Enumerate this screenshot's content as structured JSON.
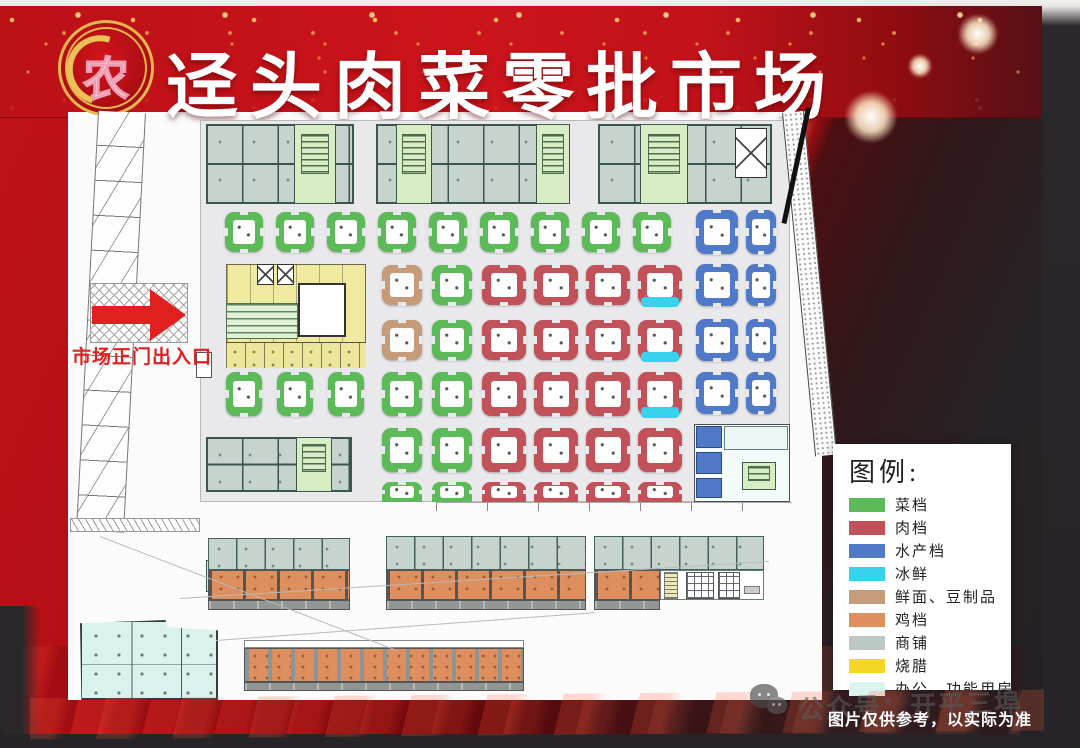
{
  "title": {
    "text": "迳头肉菜零批市场",
    "logo_char": "农"
  },
  "entrance": {
    "label": "市场正门出入口"
  },
  "legend": {
    "title": "图例:",
    "items": [
      {
        "key": "cai",
        "label": "菜档",
        "color": "#5cba58"
      },
      {
        "key": "rou",
        "label": "肉档",
        "color": "#c2525a"
      },
      {
        "key": "shuichan",
        "label": "水产档",
        "color": "#5079c8"
      },
      {
        "key": "bingxian",
        "label": "冰鲜",
        "color": "#38d2ee"
      },
      {
        "key": "xianmian",
        "label": "鲜面、豆制品",
        "color": "#c69b79"
      },
      {
        "key": "ji",
        "label": "鸡档",
        "color": "#e0905f"
      },
      {
        "key": "shangpu",
        "label": "商铺",
        "color": "#bcc8c4"
      },
      {
        "key": "shaola",
        "label": "烧腊",
        "color": "#f5d825"
      },
      {
        "key": "bangong",
        "label": "办公、功能用房",
        "color": "#dcf4f0"
      }
    ]
  },
  "footer": {
    "disclaimer": "图片仅供参考，以实际为准",
    "watermark": "公众号：开平三埠"
  },
  "plan": {
    "stalls": [
      {
        "t": "cai",
        "x": 225,
        "y": 212,
        "w": 38,
        "h": 40
      },
      {
        "t": "cai",
        "x": 276,
        "y": 212,
        "w": 38,
        "h": 40
      },
      {
        "t": "cai",
        "x": 327,
        "y": 212,
        "w": 38,
        "h": 40
      },
      {
        "t": "cai",
        "x": 378,
        "y": 212,
        "w": 38,
        "h": 40
      },
      {
        "t": "cai",
        "x": 429,
        "y": 212,
        "w": 38,
        "h": 40
      },
      {
        "t": "cai",
        "x": 480,
        "y": 212,
        "w": 38,
        "h": 40
      },
      {
        "t": "cai",
        "x": 531,
        "y": 212,
        "w": 38,
        "h": 40
      },
      {
        "t": "cai",
        "x": 582,
        "y": 212,
        "w": 38,
        "h": 40
      },
      {
        "t": "cai",
        "x": 633,
        "y": 212,
        "w": 38,
        "h": 40
      },
      {
        "t": "shuichan",
        "x": 696,
        "y": 210,
        "w": 42,
        "h": 44
      },
      {
        "t": "shuichan",
        "x": 746,
        "y": 210,
        "w": 30,
        "h": 44
      },
      {
        "t": "xianmian",
        "x": 382,
        "y": 265,
        "w": 40,
        "h": 40
      },
      {
        "t": "cai",
        "x": 432,
        "y": 265,
        "w": 40,
        "h": 40
      },
      {
        "t": "rou",
        "x": 482,
        "y": 265,
        "w": 44,
        "h": 40
      },
      {
        "t": "rou",
        "x": 534,
        "y": 265,
        "w": 44,
        "h": 40
      },
      {
        "t": "rou",
        "x": 586,
        "y": 265,
        "w": 44,
        "h": 40
      },
      {
        "t": "rou",
        "x": 638,
        "y": 265,
        "w": 44,
        "h": 40,
        "c": 1
      },
      {
        "t": "shuichan",
        "x": 696,
        "y": 264,
        "w": 42,
        "h": 42
      },
      {
        "t": "shuichan",
        "x": 746,
        "y": 264,
        "w": 30,
        "h": 42
      },
      {
        "t": "xianmian",
        "x": 382,
        "y": 320,
        "w": 40,
        "h": 40
      },
      {
        "t": "cai",
        "x": 432,
        "y": 320,
        "w": 40,
        "h": 40
      },
      {
        "t": "rou",
        "x": 482,
        "y": 320,
        "w": 44,
        "h": 40
      },
      {
        "t": "rou",
        "x": 534,
        "y": 320,
        "w": 44,
        "h": 40
      },
      {
        "t": "rou",
        "x": 586,
        "y": 320,
        "w": 44,
        "h": 40
      },
      {
        "t": "rou",
        "x": 638,
        "y": 320,
        "w": 44,
        "h": 40,
        "c": 1
      },
      {
        "t": "shuichan",
        "x": 696,
        "y": 319,
        "w": 42,
        "h": 42
      },
      {
        "t": "shuichan",
        "x": 746,
        "y": 319,
        "w": 30,
        "h": 42
      },
      {
        "t": "cai",
        "x": 226,
        "y": 372,
        "w": 36,
        "h": 44
      },
      {
        "t": "cai",
        "x": 277,
        "y": 372,
        "w": 36,
        "h": 44
      },
      {
        "t": "cai",
        "x": 328,
        "y": 372,
        "w": 36,
        "h": 44
      },
      {
        "t": "cai",
        "x": 382,
        "y": 372,
        "w": 40,
        "h": 44
      },
      {
        "t": "cai",
        "x": 432,
        "y": 372,
        "w": 40,
        "h": 44
      },
      {
        "t": "rou",
        "x": 482,
        "y": 372,
        "w": 44,
        "h": 44
      },
      {
        "t": "rou",
        "x": 534,
        "y": 372,
        "w": 44,
        "h": 44
      },
      {
        "t": "rou",
        "x": 586,
        "y": 372,
        "w": 44,
        "h": 44
      },
      {
        "t": "rou",
        "x": 638,
        "y": 372,
        "w": 44,
        "h": 44,
        "c": 1
      },
      {
        "t": "shuichan",
        "x": 696,
        "y": 372,
        "w": 42,
        "h": 42
      },
      {
        "t": "shuichan",
        "x": 746,
        "y": 372,
        "w": 30,
        "h": 42
      },
      {
        "t": "cai",
        "x": 382,
        "y": 428,
        "w": 40,
        "h": 44
      },
      {
        "t": "cai",
        "x": 432,
        "y": 428,
        "w": 40,
        "h": 44
      },
      {
        "t": "rou",
        "x": 482,
        "y": 428,
        "w": 44,
        "h": 44
      },
      {
        "t": "rou",
        "x": 534,
        "y": 428,
        "w": 44,
        "h": 44
      },
      {
        "t": "rou",
        "x": 586,
        "y": 428,
        "w": 44,
        "h": 44
      },
      {
        "t": "rou",
        "x": 638,
        "y": 428,
        "w": 44,
        "h": 44
      },
      {
        "t": "cai",
        "x": 382,
        "y": 482,
        "w": 40,
        "h": 20,
        "p": 1
      },
      {
        "t": "cai",
        "x": 432,
        "y": 482,
        "w": 40,
        "h": 20,
        "p": 1
      },
      {
        "t": "rou",
        "x": 482,
        "y": 482,
        "w": 44,
        "h": 20,
        "p": 1
      },
      {
        "t": "rou",
        "x": 534,
        "y": 482,
        "w": 44,
        "h": 20,
        "p": 1
      },
      {
        "t": "rou",
        "x": 586,
        "y": 482,
        "w": 44,
        "h": 20,
        "p": 1
      },
      {
        "t": "rou",
        "x": 638,
        "y": 482,
        "w": 44,
        "h": 20,
        "p": 1
      }
    ]
  }
}
